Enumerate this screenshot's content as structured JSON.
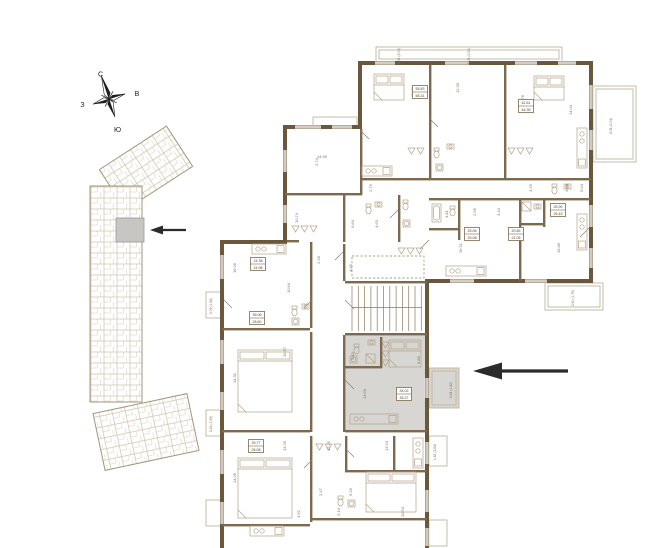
{
  "title": "Building floor plan with selected apartment",
  "colors": {
    "wall": "#6b573c",
    "wall_inner": "#7d6a4e",
    "thin_line": "#8d7b60",
    "furniture": "#b2a288",
    "balcony": "#b9ac92",
    "text": "#83755d",
    "highlight_gray": "#d8d6d3",
    "arrow_black": "#2b2b2b",
    "minimap_line": "#c6b99f",
    "minimap_wall": "#a6947a"
  },
  "compass": {
    "n": "С",
    "e": "В",
    "s": "Ю",
    "w": "З"
  },
  "key_plan": {
    "selected_unit_highlighted": true
  },
  "plan": {
    "area_labels": [
      {
        "t": "15.89",
        "x": 414,
        "y": 92,
        "r": 1
      },
      {
        "t": "12.30",
        "x": 459,
        "y": 88,
        "r": 1
      },
      {
        "t": "14.59",
        "x": 322,
        "y": 158,
        "r": 0
      },
      {
        "t": "15.76",
        "x": 524,
        "y": 100,
        "r": 1
      },
      {
        "t": "14.04",
        "x": 572,
        "y": 110,
        "r": 1
      },
      {
        "t": "16.86",
        "x": 560,
        "y": 248,
        "r": 1
      },
      {
        "t": "16.51",
        "x": 462,
        "y": 248,
        "r": 1
      },
      {
        "t": "3.08",
        "x": 568,
        "y": 188,
        "r": 1
      },
      {
        "t": "5.04",
        "x": 583,
        "y": 188,
        "r": 1
      },
      {
        "t": "3.29",
        "x": 532,
        "y": 188,
        "r": 1
      },
      {
        "t": "2.96",
        "x": 476,
        "y": 212,
        "r": 1
      },
      {
        "t": "3.43",
        "x": 500,
        "y": 212,
        "r": 1
      },
      {
        "t": "4.81",
        "x": 448,
        "y": 214,
        "r": 1
      },
      {
        "t": "10.74",
        "x": 298,
        "y": 218,
        "r": 1
      },
      {
        "t": "9.84",
        "x": 354,
        "y": 224,
        "r": 1
      },
      {
        "t": "4.63",
        "x": 378,
        "y": 224,
        "r": 1
      },
      {
        "t": "2.79",
        "x": 372,
        "y": 188,
        "r": 1
      },
      {
        "t": "2.74",
        "x": 318,
        "y": 162,
        "r": 1
      },
      {
        "t": "16.06",
        "x": 236,
        "y": 268,
        "r": 1
      },
      {
        "t": "10.64",
        "x": 290,
        "y": 288,
        "r": 1
      },
      {
        "t": "2.28",
        "x": 320,
        "y": 260,
        "r": 1
      },
      {
        "t": "4.65",
        "x": 352,
        "y": 268,
        "r": 1
      },
      {
        "t": "14.31",
        "x": 236,
        "y": 378,
        "r": 1
      },
      {
        "t": "16.57",
        "x": 286,
        "y": 352,
        "r": 1
      },
      {
        "t": "13.99",
        "x": 366,
        "y": 394,
        "r": 1
      },
      {
        "t": "3.43",
        "x": 354,
        "y": 356,
        "r": 1
      },
      {
        "t": "9.80",
        "x": 420,
        "y": 360,
        "r": 1
      },
      {
        "t": "14.06",
        "x": 236,
        "y": 478,
        "r": 1
      },
      {
        "t": "13.26",
        "x": 286,
        "y": 446,
        "r": 1
      },
      {
        "t": "12.25",
        "x": 330,
        "y": 446,
        "r": 1
      },
      {
        "t": "13.24",
        "x": 388,
        "y": 446,
        "r": 1
      },
      {
        "t": "9.26",
        "x": 352,
        "y": 492,
        "r": 1
      },
      {
        "t": "2.47",
        "x": 322,
        "y": 492,
        "r": 1
      },
      {
        "t": "3.10",
        "x": 340,
        "y": 512,
        "r": 1
      },
      {
        "t": "4.92",
        "x": 300,
        "y": 514,
        "r": 1
      },
      {
        "t": "10.54",
        "x": 404,
        "y": 512,
        "r": 1
      }
    ],
    "balcony_labels": [
      {
        "t": "6.06 (3.03)",
        "x": 400,
        "y": 56,
        "r": 1
      },
      {
        "t": "5.06 (2.53)",
        "x": 470,
        "y": 56,
        "r": 1
      },
      {
        "t": "4.08 (2.04)",
        "x": 612,
        "y": 126,
        "r": 1
      },
      {
        "t": "3.60 (1.75)",
        "x": 574,
        "y": 298,
        "r": 1
      },
      {
        "t": "3.09 (1.56)",
        "x": 212,
        "y": 306,
        "r": 1
      },
      {
        "t": "3.18 (1.59)",
        "x": 212,
        "y": 424,
        "r": 1
      },
      {
        "t": "3.64 (1.82)",
        "x": 452,
        "y": 390,
        "r": 1
      },
      {
        "t": "1.82 (3.64)",
        "x": 436,
        "y": 452,
        "r": 1
      }
    ],
    "unit_plates": [
      {
        "a": "55.83",
        "b": "58.31",
        "x": 420,
        "y": 92
      },
      {
        "a": "42.61",
        "b": "44.35",
        "x": 526,
        "y": 106
      },
      {
        "a": "25.90",
        "b": "25.43",
        "x": 558,
        "y": 210
      },
      {
        "a": "25.08",
        "b": "25.08",
        "x": 472,
        "y": 234
      },
      {
        "a": "20.85",
        "b": "21.05",
        "x": 516,
        "y": 234
      },
      {
        "a": "24.38",
        "b": "24.98",
        "x": 258,
        "y": 264
      },
      {
        "a": "35.06",
        "b": "28.60",
        "x": 257,
        "y": 318
      },
      {
        "a": "34.02",
        "b": "35.27",
        "x": 404,
        "y": 394
      },
      {
        "a": "25.77",
        "b": "26.08",
        "x": 256,
        "y": 446
      }
    ]
  }
}
